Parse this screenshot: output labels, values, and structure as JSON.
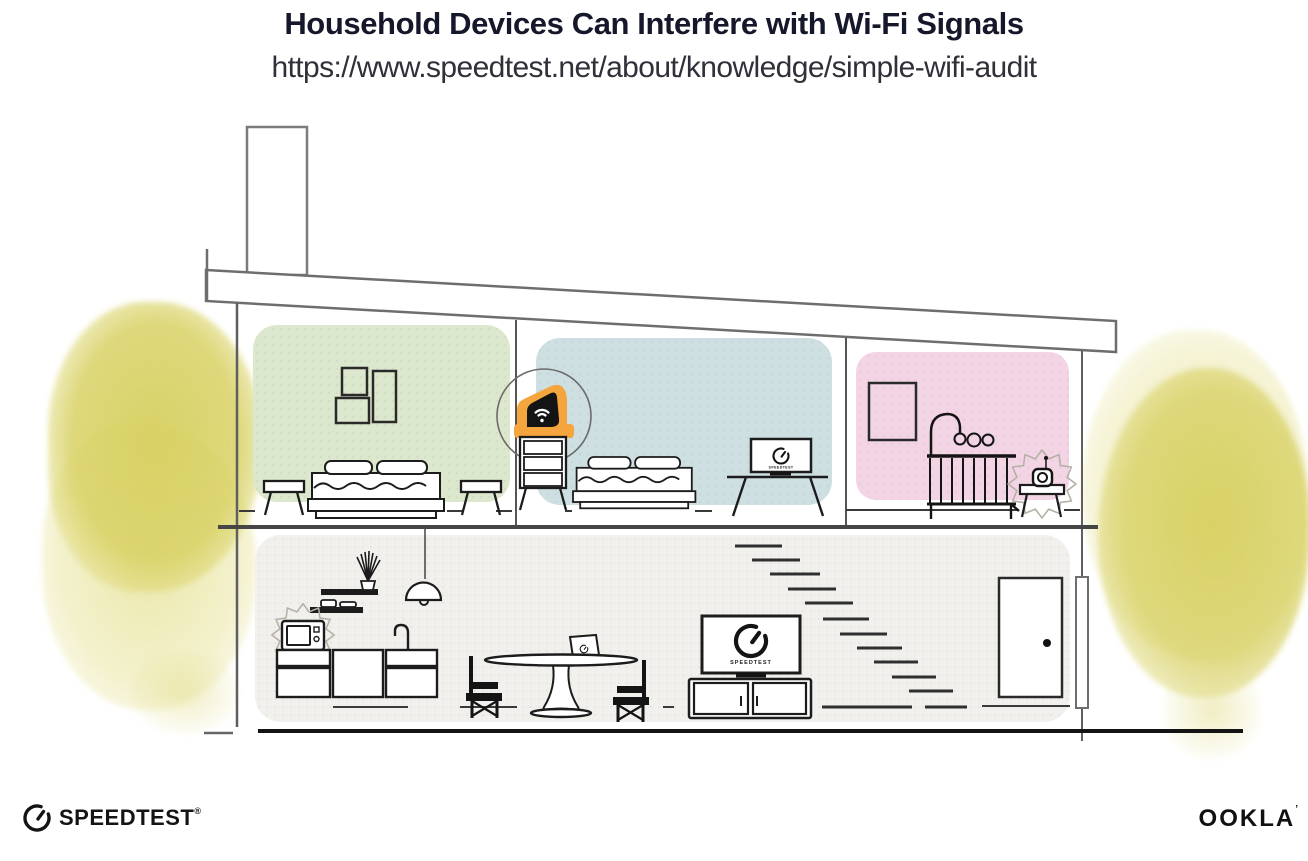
{
  "header": {
    "title": "Household Devices Can Interfere with Wi-Fi Signals",
    "url": "https://www.speedtest.net/about/knowledge/simple-wifi-audit"
  },
  "illustration": {
    "tv_screen_label": "SPEEDTEST",
    "monitor_screen_label": "SPEEDTEST",
    "colors": {
      "room_green": "#dce8cd",
      "room_blue": "#cedfe2",
      "room_pink": "#f3d4e4",
      "ground_floor_gray": "#f1f0ed",
      "router_highlight_orange": "#f5a53d",
      "tree_yellow": "#d8d164",
      "structure_gray": "#6e6e6e",
      "ink_black": "#1c1c1c"
    },
    "icons": [
      "wifi-router-icon",
      "speedtest-gauge-icon",
      "interference-burst-icon",
      "pendant-lamp-icon",
      "baby-monitor-icon"
    ]
  },
  "footer": {
    "speedtest_label": "SPEEDTEST",
    "speedtest_reg_mark": "®",
    "ookla_label": "OOKLA",
    "ookla_reg_mark": "’"
  }
}
